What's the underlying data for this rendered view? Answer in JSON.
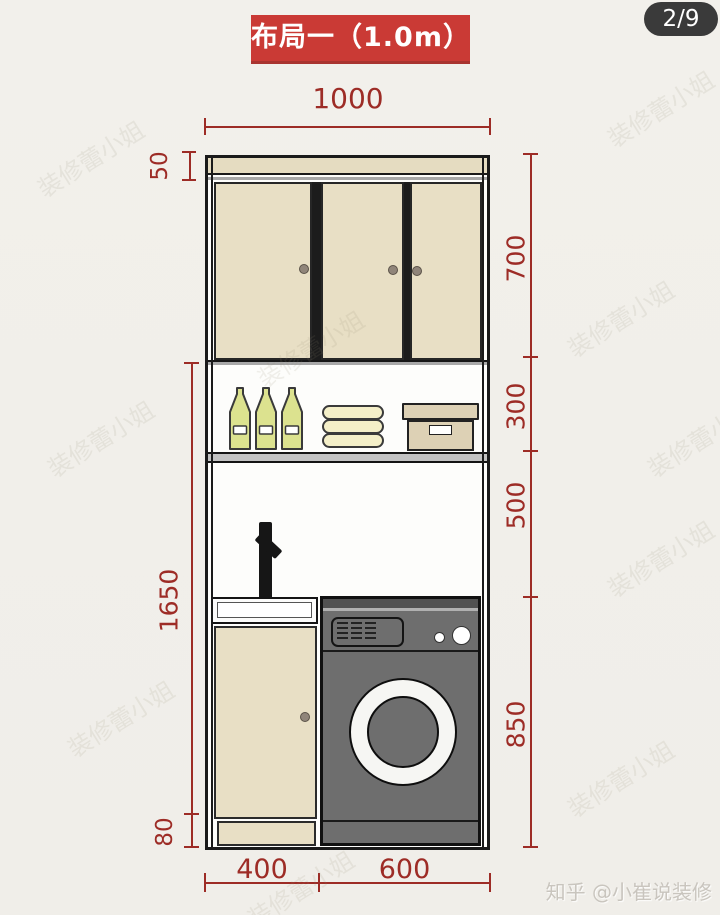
{
  "badge": {
    "label": "2/9"
  },
  "title": {
    "label": "布局一（1.0m）"
  },
  "dims": {
    "top": "1000",
    "left_top": "50",
    "left_mid": "1650",
    "left_bottom": "80",
    "right_1": "700",
    "right_2": "300",
    "right_3": "500",
    "right_4": "850",
    "bottom_1": "400",
    "bottom_2": "600"
  },
  "credit": {
    "label": "知乎 @小崔说装修"
  },
  "watermark": {
    "label": "装修蕾小姐"
  },
  "colors": {
    "banner_red": "#ca3a35",
    "dimension_red": "#9d2c26",
    "badge_gray": "#3a3a3a",
    "cabinet_beige": "#e8dfc5",
    "bottle_green": "#dce28f",
    "towel_yellow": "#f4efc8",
    "box_tan": "#ddd1b5",
    "machine_gray": "#6e6e6e"
  }
}
